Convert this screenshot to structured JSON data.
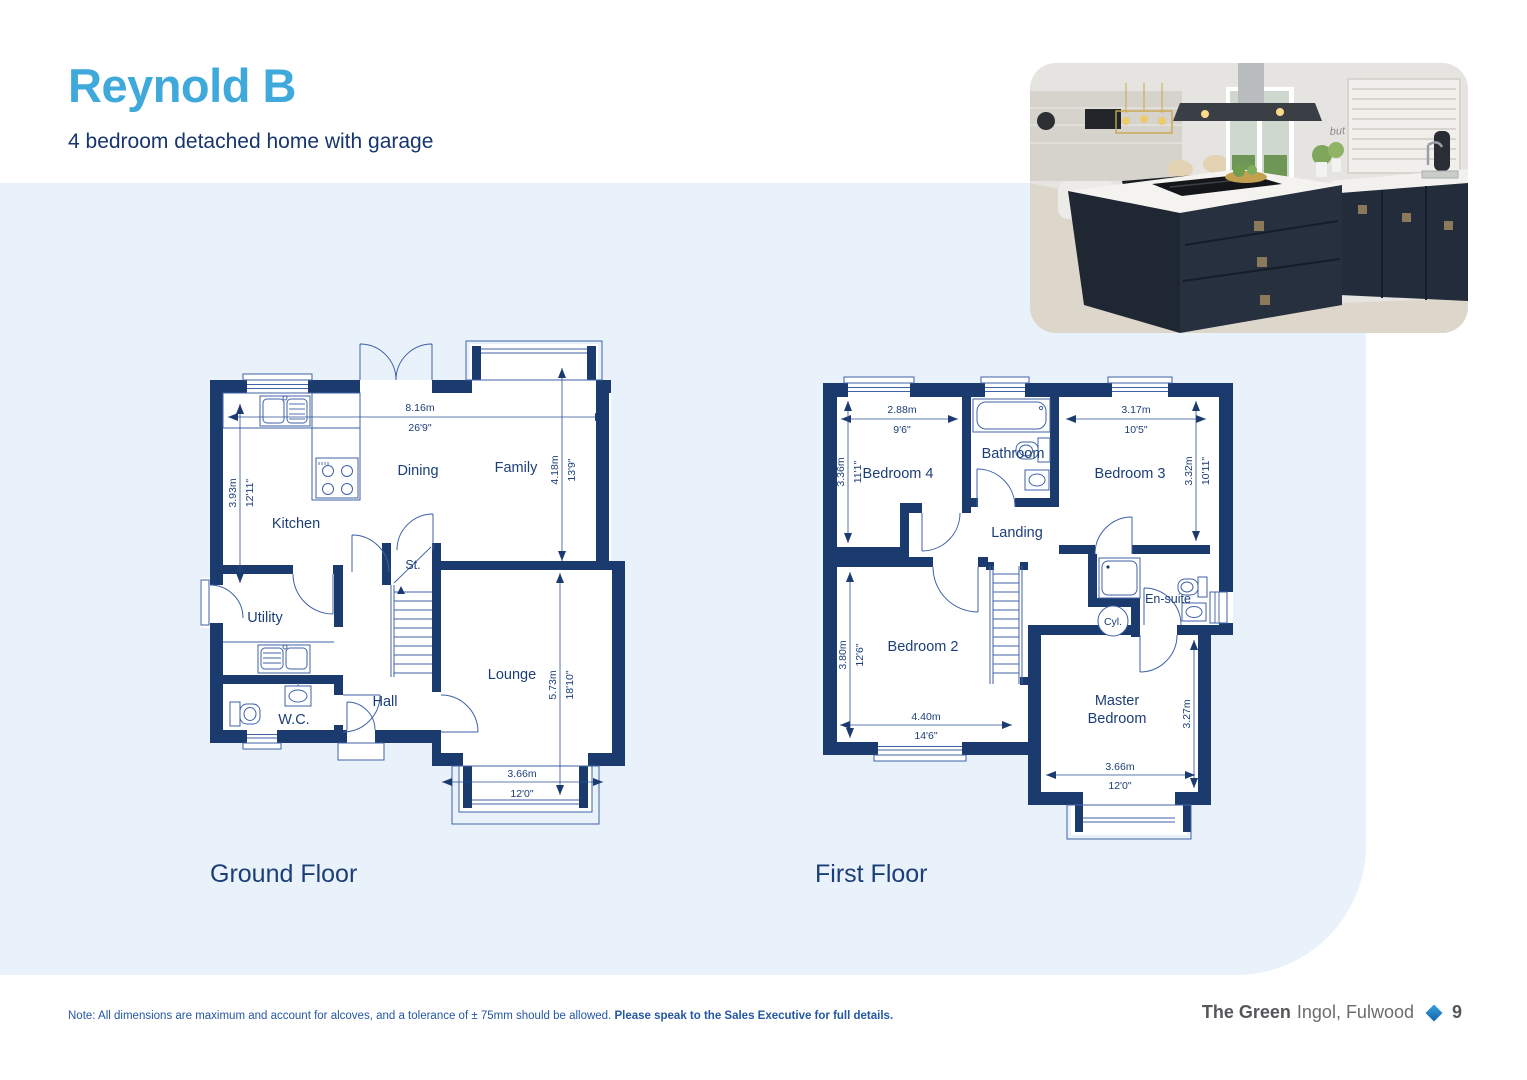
{
  "page": {
    "title": "Reynold B",
    "subtitle": "4 bedroom detached home with garage",
    "note": {
      "regular": "Note: All dimensions are maximum and account for alcoves, and a tolerance of ± 75mm should be allowed. ",
      "bold": "Please speak to the Sales Executive for full details."
    },
    "footer": {
      "development": "The Green",
      "location": "Ingol, Fulwood",
      "page_number": "9"
    }
  },
  "photo": {
    "wall_art_text": "but first, coffee"
  },
  "colors": {
    "accent": "#3fa9dc",
    "navy": "#1b3a6e",
    "band": "#e9f1fa",
    "line": "#3f62a6"
  },
  "ground_floor": {
    "title": "Ground Floor",
    "rooms": {
      "kitchen": "Kitchen",
      "dining": "Dining",
      "family": "Family",
      "utility": "Utility",
      "wc": "W.C.",
      "hall": "Hall",
      "store": "St.",
      "lounge": "Lounge"
    },
    "dims": {
      "overall_width": {
        "metric": "8.16m",
        "imperial": "26'9\""
      },
      "kitchen_depth": {
        "metric": "3.93m",
        "imperial": "12'11\""
      },
      "family_depth": {
        "metric": "4.18m",
        "imperial": "13'9\""
      },
      "lounge_depth": {
        "metric": "5.73m",
        "imperial": "18'10\""
      },
      "lounge_width": {
        "metric": "3.66m",
        "imperial": "12'0\""
      }
    }
  },
  "first_floor": {
    "title": "First Floor",
    "rooms": {
      "bedroom4": "Bedroom 4",
      "bathroom": "Bathroom",
      "bedroom3": "Bedroom 3",
      "landing": "Landing",
      "bedroom2": "Bedroom 2",
      "master_line1": "Master",
      "master_line2": "Bedroom",
      "ensuite": "En-suite",
      "cylinder": "Cyl."
    },
    "dims": {
      "bedroom4_width": {
        "metric": "2.88m",
        "imperial": "9'6\""
      },
      "bedroom4_depth": {
        "metric": "3.36m",
        "imperial": "11'1\""
      },
      "bedroom3_width": {
        "metric": "3.17m",
        "imperial": "10'5\""
      },
      "bedroom3_depth": {
        "metric": "3.32m",
        "imperial": "10'11\""
      },
      "bedroom2_depth": {
        "metric": "3.80m",
        "imperial": "12'6\""
      },
      "bedroom2_width": {
        "metric": "4.40m",
        "imperial": "14'6\""
      },
      "master_depth": {
        "metric": "3.27m",
        "imperial": "10'9\""
      },
      "master_width": {
        "metric": "3.66m",
        "imperial": "12'0\""
      }
    }
  }
}
